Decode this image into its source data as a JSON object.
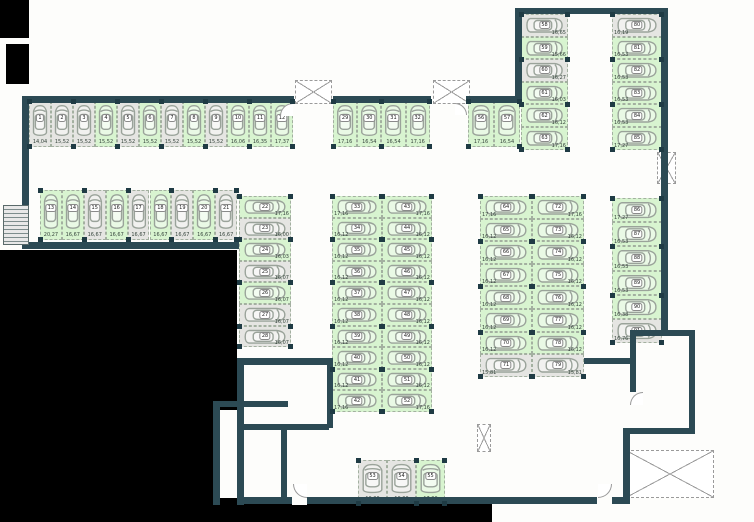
{
  "plan": {
    "title": "parking-level-floor-plan",
    "colors": {
      "wall": "#2c4a54",
      "space_available": "#d8f4d0",
      "space_unavailable": "#e5e5e2",
      "void": "#000000",
      "space_border": "#a3b0a0"
    },
    "groups": [
      {
        "id": "row-top-left",
        "x": 29,
        "y": 101,
        "dir": "row",
        "cw": 22,
        "ch": 46,
        "car": "v",
        "lp": "b",
        "spaces": [
          {
            "n": "1",
            "a": "14,04",
            "c": "y"
          },
          {
            "n": "2",
            "a": "15,52",
            "c": "y"
          },
          {
            "n": "3",
            "a": "15,52",
            "c": "y"
          },
          {
            "n": "4",
            "a": "15,52",
            "c": "g"
          },
          {
            "n": "5",
            "a": "15,52",
            "c": "y"
          },
          {
            "n": "6",
            "a": "15,52",
            "c": "g"
          },
          {
            "n": "7",
            "a": "15,52",
            "c": "y"
          },
          {
            "n": "8",
            "a": "15,52",
            "c": "g"
          },
          {
            "n": "9",
            "a": "15,52",
            "c": "y"
          },
          {
            "n": "10",
            "a": "16,06",
            "c": "g"
          },
          {
            "n": "11",
            "a": "16,35",
            "c": "g"
          },
          {
            "n": "12",
            "a": "17,37",
            "c": "g"
          }
        ]
      },
      {
        "id": "row-left-second",
        "x": 40,
        "y": 190,
        "dir": "row",
        "cw": 21.9,
        "ch": 50,
        "car": "v",
        "lp": "b",
        "spaces": [
          {
            "n": "13",
            "a": "20,27",
            "c": "g"
          },
          {
            "n": "14",
            "a": "16,67",
            "c": "g"
          },
          {
            "n": "15",
            "a": "16,67",
            "c": "y"
          },
          {
            "n": "16",
            "a": "16,67",
            "c": "g"
          },
          {
            "n": "17",
            "a": "16,67",
            "c": "y"
          },
          {
            "n": "18",
            "a": "16,67",
            "c": "g"
          },
          {
            "n": "19",
            "a": "16,67",
            "c": "y"
          },
          {
            "n": "20",
            "a": "16,67",
            "c": "g"
          },
          {
            "n": "21",
            "a": "16,67",
            "c": "y"
          }
        ]
      },
      {
        "id": "stack-left-block-east",
        "x": 239,
        "y": 196,
        "dir": "col",
        "cw": 52,
        "ch": 21.6,
        "car": "h",
        "lp": "r",
        "spaces": [
          {
            "n": "22",
            "a": "17,16",
            "c": "g"
          },
          {
            "n": "23",
            "a": "16,00",
            "c": "y"
          },
          {
            "n": "24",
            "a": "16,03",
            "c": "g"
          },
          {
            "n": "25",
            "a": "16,07",
            "c": "y"
          },
          {
            "n": "26",
            "a": "16,07",
            "c": "g"
          },
          {
            "n": "27",
            "a": "16,07",
            "c": "y"
          },
          {
            "n": "28",
            "a": "16,07",
            "c": "y"
          }
        ]
      },
      {
        "id": "row-middle-top",
        "x": 333,
        "y": 101,
        "dir": "row",
        "cw": 24.2,
        "ch": 46,
        "car": "v",
        "lp": "b",
        "spaces": [
          {
            "n": "29",
            "a": "17,16",
            "c": "g"
          },
          {
            "n": "30",
            "a": "16,54",
            "c": "g"
          },
          {
            "n": "31",
            "a": "16,54",
            "c": "g"
          },
          {
            "n": "32",
            "a": "17,16",
            "c": "g"
          }
        ]
      },
      {
        "id": "row-middle-top-east",
        "x": 468,
        "y": 101,
        "dir": "row",
        "cw": 26,
        "ch": 46,
        "car": "v",
        "lp": "b",
        "spaces": [
          {
            "n": "56",
            "a": "17,16",
            "c": "g"
          },
          {
            "n": "57",
            "a": "16,54",
            "c": "g"
          }
        ]
      },
      {
        "id": "stack-topright-west",
        "x": 521,
        "y": 14,
        "dir": "col",
        "cw": 47,
        "ch": 22.6,
        "car": "h",
        "lp": "r",
        "spaces": [
          {
            "n": "58",
            "a": "16,65",
            "c": "y"
          },
          {
            "n": "59",
            "a": "15,66",
            "c": "g"
          },
          {
            "n": "60",
            "a": "16,27",
            "c": "y"
          },
          {
            "n": "61",
            "a": "16,03",
            "c": "g"
          },
          {
            "n": "62",
            "a": "16,12",
            "c": "g"
          },
          {
            "n": "63",
            "a": "17,16",
            "c": "g"
          }
        ]
      },
      {
        "id": "stack-topright-east",
        "x": 612,
        "y": 14,
        "dir": "col",
        "cw": 50,
        "ch": 22.6,
        "car": "h",
        "lp": "l",
        "spaces": [
          {
            "n": "80",
            "a": "16,19",
            "c": "y"
          },
          {
            "n": "81",
            "a": "16,53",
            "c": "g"
          },
          {
            "n": "82",
            "a": "16,53",
            "c": "g"
          },
          {
            "n": "83",
            "a": "16,53",
            "c": "g"
          },
          {
            "n": "84",
            "a": "16,53",
            "c": "g"
          },
          {
            "n": "85",
            "a": "17,27",
            "c": "g"
          }
        ]
      },
      {
        "id": "column-center-west",
        "x": 332,
        "y": 196,
        "dir": "col",
        "cw": 50,
        "ch": 21.6,
        "car": "h",
        "lp": "l",
        "spaces": [
          {
            "n": "33",
            "a": "17,16",
            "c": "g"
          },
          {
            "n": "34",
            "a": "16,12",
            "c": "g"
          },
          {
            "n": "35",
            "a": "16,12",
            "c": "g"
          },
          {
            "n": "36",
            "a": "16,12",
            "c": "g"
          },
          {
            "n": "37",
            "a": "16,12",
            "c": "g"
          },
          {
            "n": "38",
            "a": "16,12",
            "c": "g"
          },
          {
            "n": "39",
            "a": "16,12",
            "c": "g"
          },
          {
            "n": "40",
            "a": "16,12",
            "c": "g"
          },
          {
            "n": "41",
            "a": "16,12",
            "c": "g"
          },
          {
            "n": "42",
            "a": "17,16",
            "c": "g"
          }
        ]
      },
      {
        "id": "column-center-east",
        "x": 382,
        "y": 196,
        "dir": "col",
        "cw": 50,
        "ch": 21.6,
        "car": "h",
        "lp": "r",
        "spaces": [
          {
            "n": "43",
            "a": "17,16",
            "c": "g"
          },
          {
            "n": "44",
            "a": "16,12",
            "c": "g"
          },
          {
            "n": "45",
            "a": "16,12",
            "c": "g"
          },
          {
            "n": "46",
            "a": "16,12",
            "c": "g"
          },
          {
            "n": "47",
            "a": "16,12",
            "c": "g"
          },
          {
            "n": "48",
            "a": "16,12",
            "c": "g"
          },
          {
            "n": "49",
            "a": "16,12",
            "c": "g"
          },
          {
            "n": "50",
            "a": "16,12",
            "c": "g"
          },
          {
            "n": "51",
            "a": "16,12",
            "c": "g"
          },
          {
            "n": "52",
            "a": "17,16",
            "c": "g"
          }
        ]
      },
      {
        "id": "column-right-west",
        "x": 480,
        "y": 196,
        "dir": "col",
        "cw": 52,
        "ch": 22.6,
        "car": "h",
        "lp": "l",
        "spaces": [
          {
            "n": "64",
            "a": "17,16",
            "c": "g"
          },
          {
            "n": "65",
            "a": "16,12",
            "c": "g"
          },
          {
            "n": "66",
            "a": "16,12",
            "c": "g"
          },
          {
            "n": "67",
            "a": "16,12",
            "c": "g"
          },
          {
            "n": "68",
            "a": "16,12",
            "c": "g"
          },
          {
            "n": "69",
            "a": "16,12",
            "c": "g"
          },
          {
            "n": "70",
            "a": "16,12",
            "c": "g"
          },
          {
            "n": "71",
            "a": "15,81",
            "c": "y"
          }
        ]
      },
      {
        "id": "column-right-east",
        "x": 532,
        "y": 196,
        "dir": "col",
        "cw": 52,
        "ch": 22.6,
        "car": "h",
        "lp": "r",
        "spaces": [
          {
            "n": "72",
            "a": "17,16",
            "c": "g"
          },
          {
            "n": "73",
            "a": "16,12",
            "c": "g"
          },
          {
            "n": "74",
            "a": "16,12",
            "c": "g"
          },
          {
            "n": "75",
            "a": "16,12",
            "c": "g"
          },
          {
            "n": "76",
            "a": "16,12",
            "c": "g"
          },
          {
            "n": "77",
            "a": "16,12",
            "c": "g"
          },
          {
            "n": "78",
            "a": "16,12",
            "c": "g"
          },
          {
            "n": "79",
            "a": "15,81",
            "c": "y"
          }
        ]
      },
      {
        "id": "stack-fareast-lower",
        "x": 612,
        "y": 198,
        "dir": "col",
        "cw": 50,
        "ch": 24.2,
        "car": "h",
        "lp": "l",
        "spaces": [
          {
            "n": "86",
            "a": "17,27",
            "c": "g"
          },
          {
            "n": "87",
            "a": "16,53",
            "c": "g"
          },
          {
            "n": "88",
            "a": "16,53",
            "c": "g"
          },
          {
            "n": "89",
            "a": "16,53",
            "c": "g"
          },
          {
            "n": "90",
            "a": "16,38",
            "c": "g"
          },
          {
            "n": "91",
            "a": "16,76",
            "c": "y"
          }
        ]
      },
      {
        "id": "row-bottom-center",
        "x": 358,
        "y": 460,
        "dir": "row",
        "cw": 29,
        "ch": 44,
        "car": "v",
        "lp": "b",
        "spaces": [
          {
            "n": "53",
            "a": "16,00",
            "c": "y"
          },
          {
            "n": "54",
            "a": "16,00",
            "c": "y"
          },
          {
            "n": "55",
            "a": "17,00",
            "c": "g"
          }
        ]
      }
    ]
  }
}
